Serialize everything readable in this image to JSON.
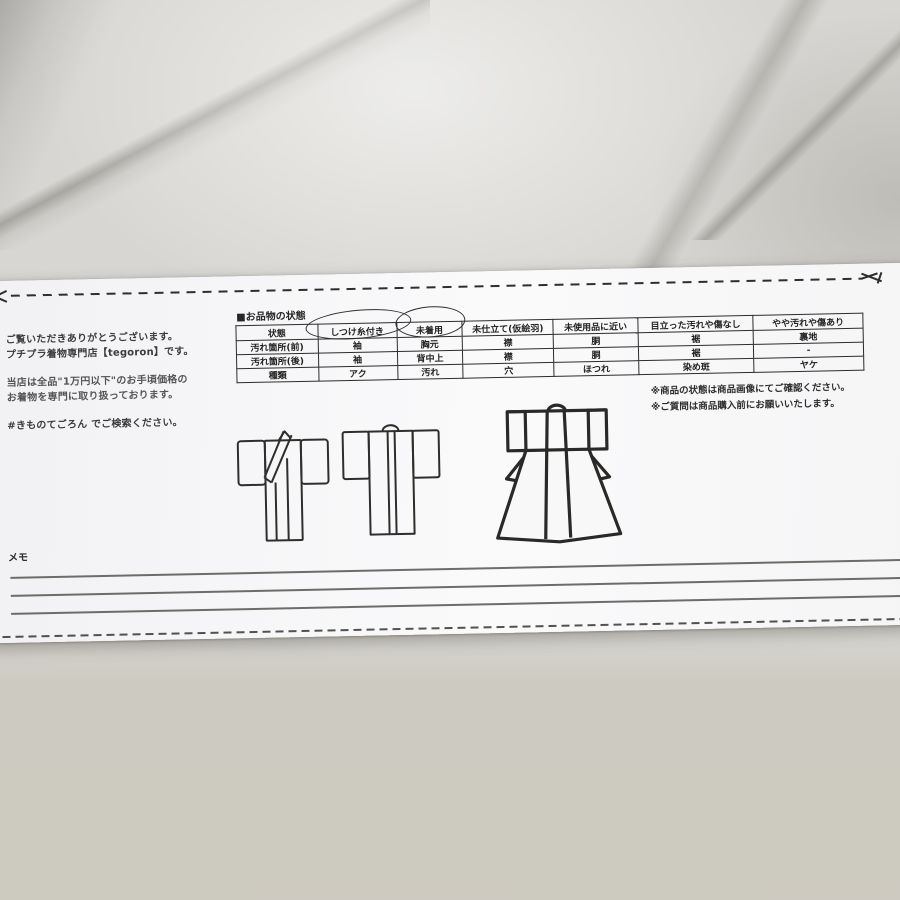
{
  "shop_info": {
    "line1": "ご覧いただきありがとうございます。",
    "line2": "プチプラ着物専門店【tegoron】です。",
    "line3": "当店は全品\"1万円以下\"のお手頃価格の",
    "line4": "お着物を専門に取り扱っております。",
    "line5": "#きものてごろん でご検索ください。"
  },
  "condition_table": {
    "title": "■お品物の状態",
    "header_row": [
      "状態",
      "しつけ糸付き",
      "未着用",
      "未仕立て(仮絵羽)",
      "未使用品に近い",
      "目立った汚れや傷なし",
      "やや汚れや傷あり"
    ],
    "rows": [
      {
        "label": "汚れ箇所(前)",
        "cells": [
          "袖",
          "胸元",
          "襟",
          "胴",
          "裾",
          "裏地"
        ]
      },
      {
        "label": "汚れ箇所(後)",
        "cells": [
          "袖",
          "背中上",
          "襟",
          "胴",
          "裾",
          "-"
        ]
      },
      {
        "label": "種類",
        "cells": [
          "アク",
          "汚れ",
          "穴",
          "ほつれ",
          "染め斑",
          "ヤケ"
        ]
      }
    ],
    "circled_headers": [
      "しつけ糸付き",
      "未着用"
    ]
  },
  "notes": {
    "note1": "※商品の状態は商品画像にてご確認ください。",
    "note2": "※ご質問は商品購入前にお願いいたします。"
  },
  "memo": {
    "label": "メモ",
    "line_count": 3
  },
  "illustrations": [
    "kimono-front-view",
    "kimono-back-view",
    "kimono-flared-back-view"
  ],
  "colors": {
    "paper": "#f7f7f8",
    "ink": "#2c2c2c",
    "marble_base": "#d7d6d2",
    "marble_bottom": "#c7c2b4"
  }
}
